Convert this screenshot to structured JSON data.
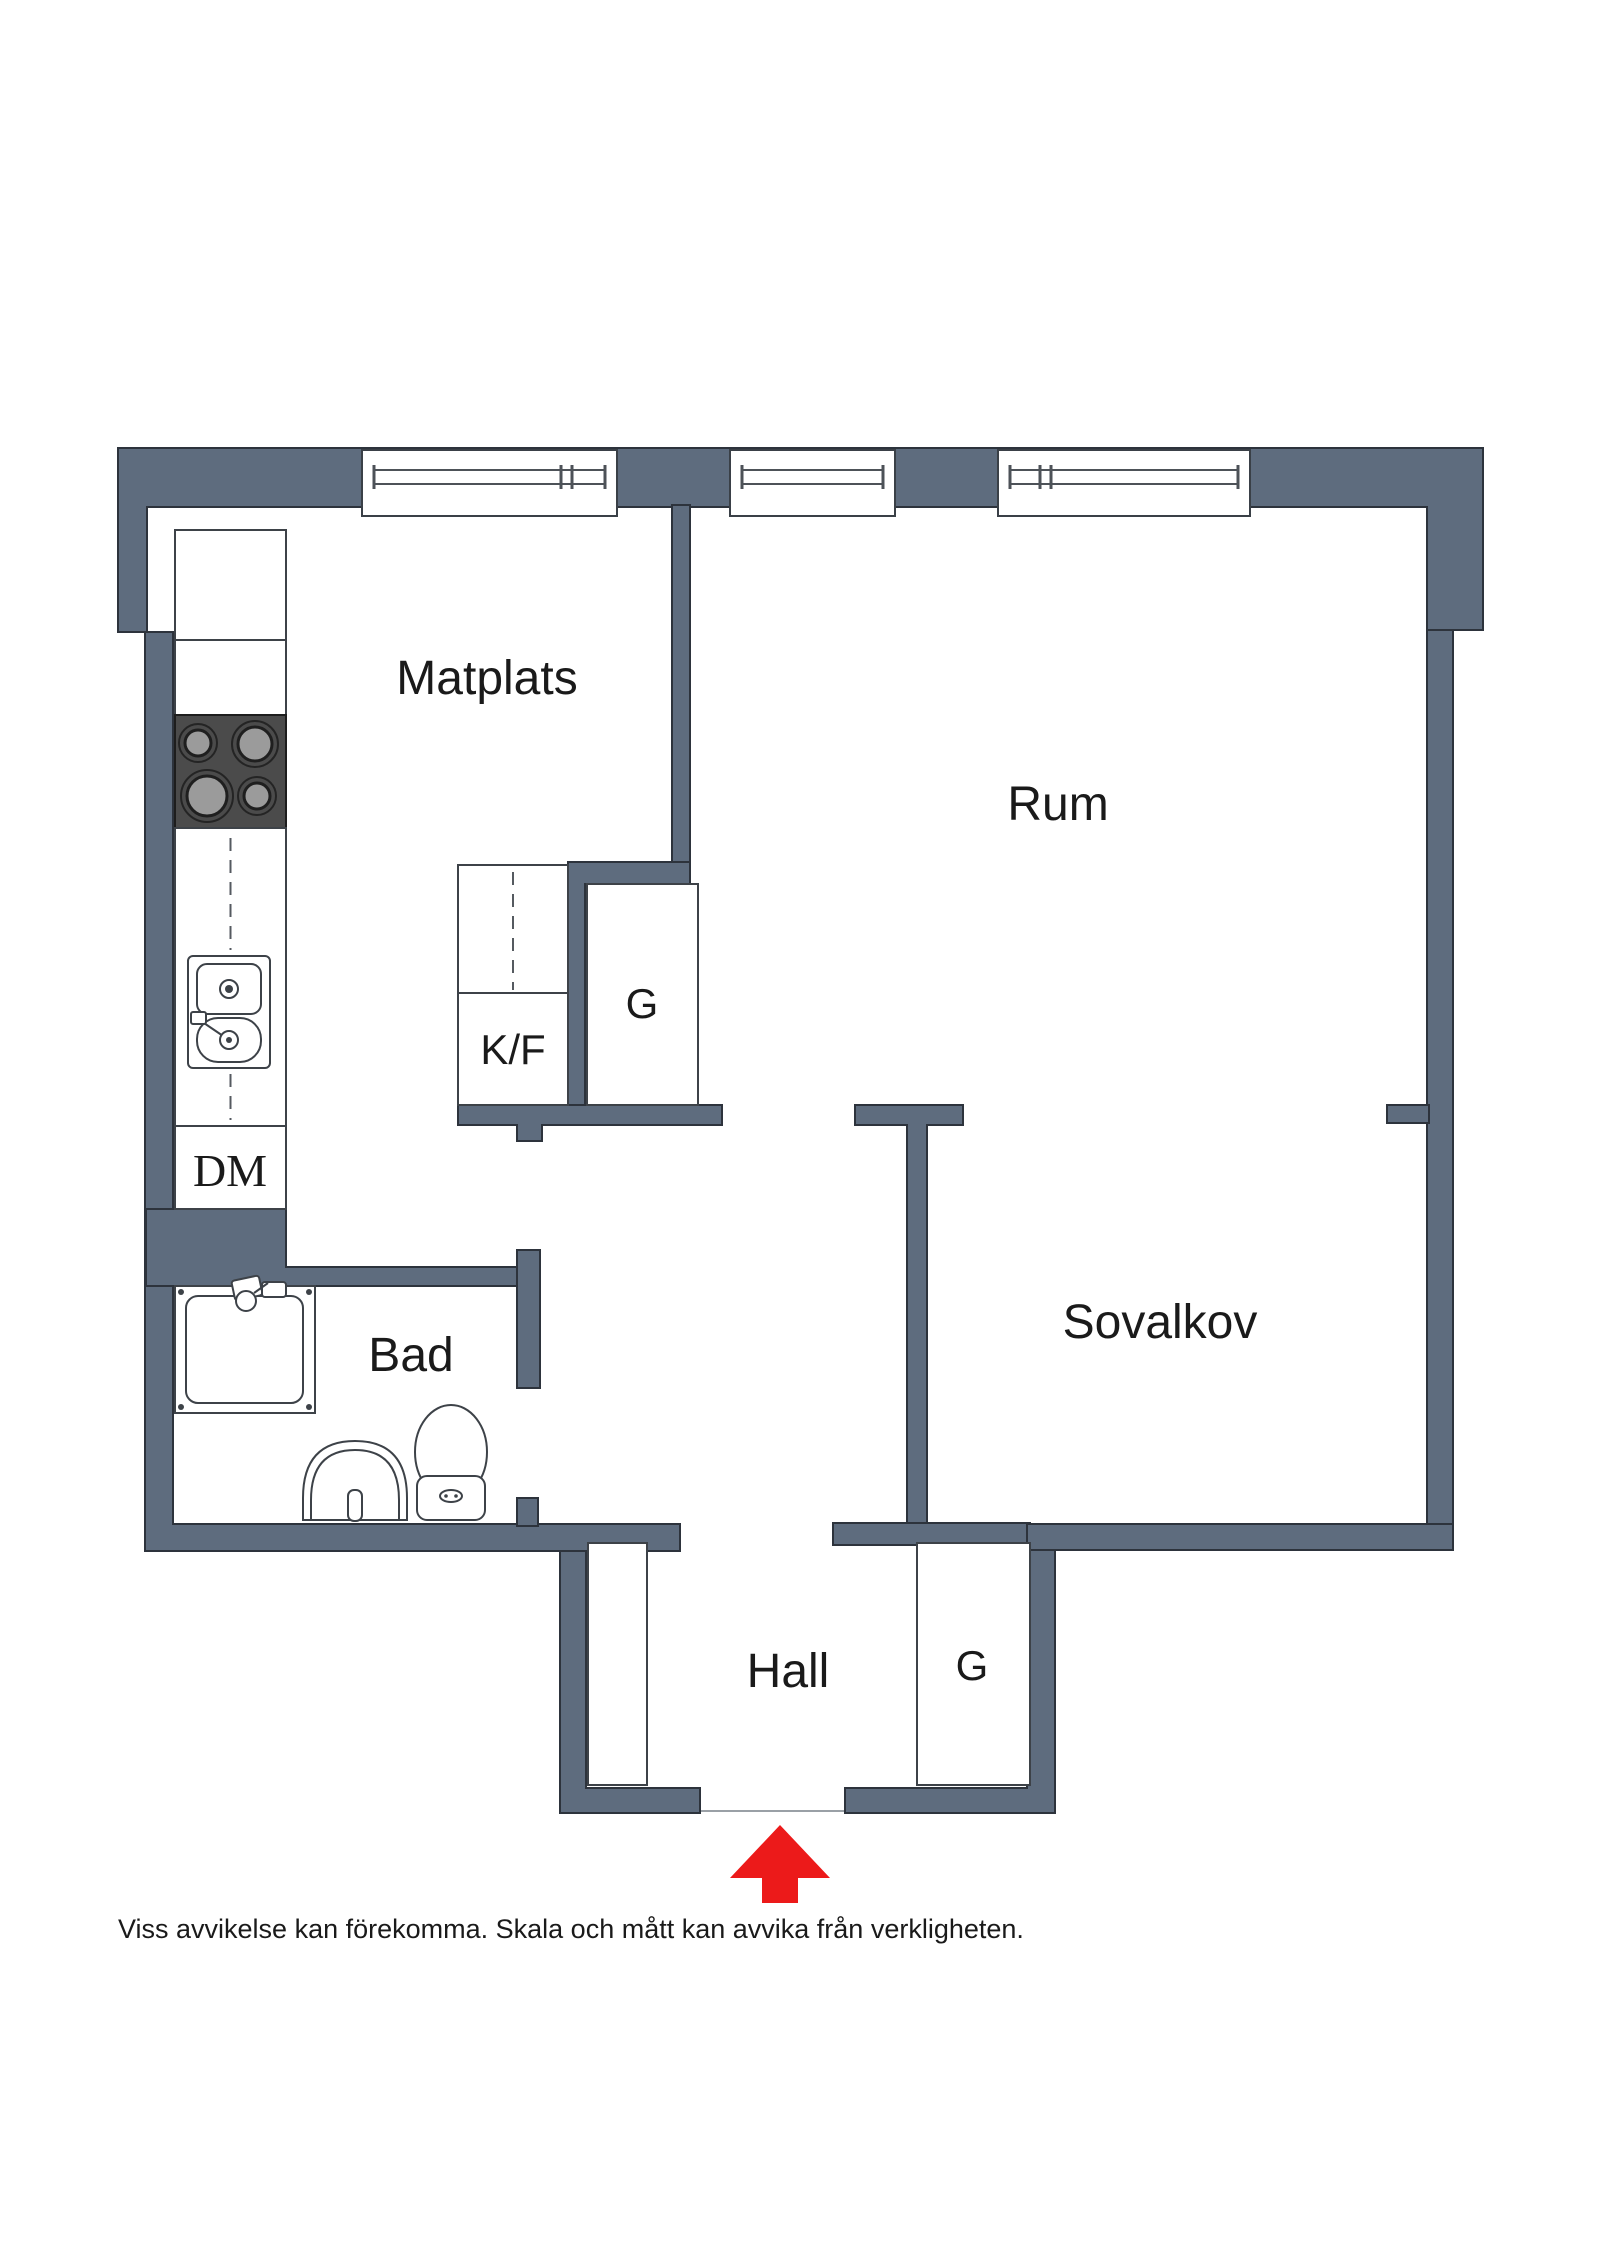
{
  "floorplan": {
    "rooms": {
      "matplats": "Matplats",
      "rum": "Rum",
      "sovalkov": "Sovalkov",
      "bad": "Bad",
      "hall": "Hall"
    },
    "closets": {
      "kf": "K/F",
      "g_left": "G",
      "g_right": "G",
      "dm": "DM"
    },
    "footer": {
      "disclaimer": "Viss avvikelse kan förekomma. Skala och mått kan avvika från verkligheten."
    },
    "colors": {
      "wall": "#5e6c7e",
      "wall_outline": "#2d333c",
      "text": "#1a1a1a",
      "stove_top": "#4b4b4b",
      "burner": "#9b9b9b",
      "arrow_red": "#ec1a1a",
      "background": "#ffffff"
    },
    "entrance": {
      "arrow_direction": "up"
    }
  }
}
